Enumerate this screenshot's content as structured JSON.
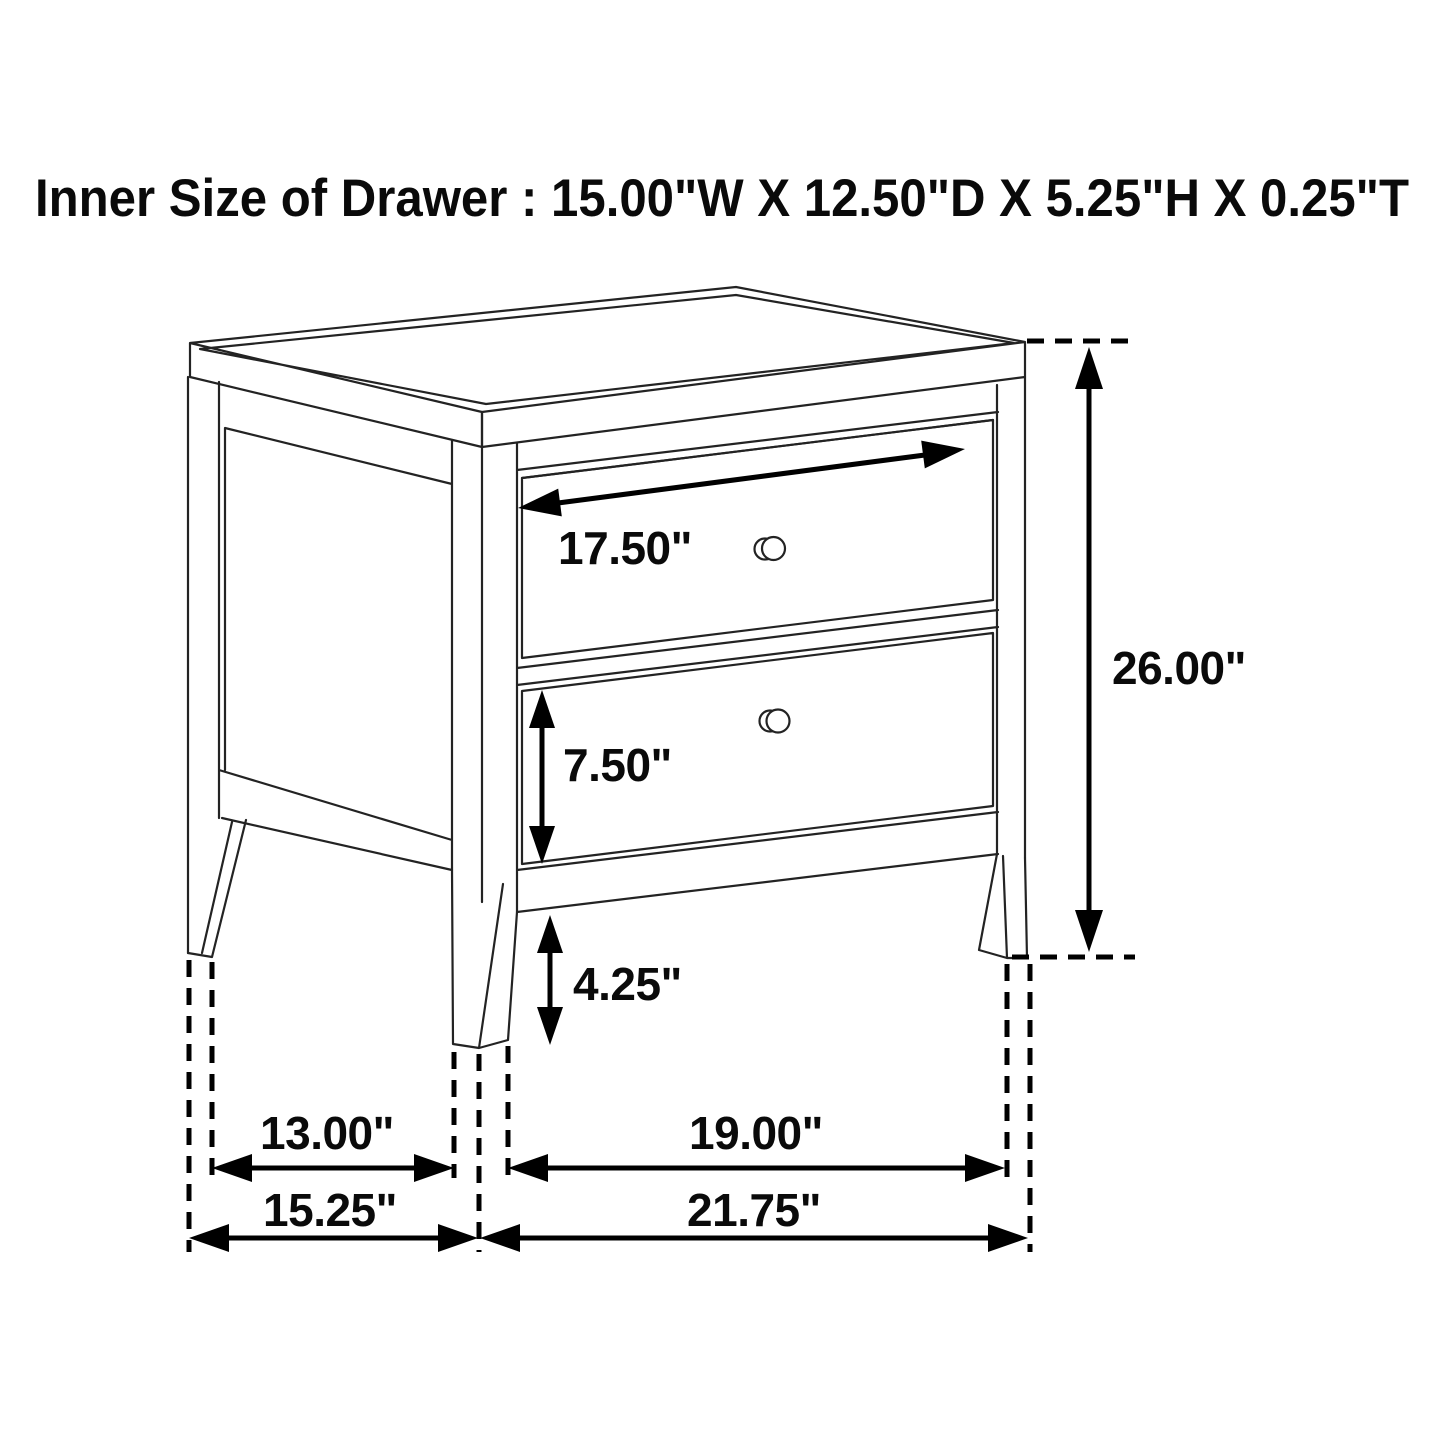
{
  "title": "Inner Size of Drawer : 15.00\"W X 12.50\"D X 5.25\"H X 0.25\"T",
  "diagram": {
    "type": "furniture-dimension-diagram",
    "item": "two-drawer nightstand line drawing",
    "colors": {
      "background": "#ffffff",
      "line": "#232323",
      "dimension": "#000000"
    },
    "labels": {
      "drawer_face_width": "17.50\"",
      "overall_height": "26.00\"",
      "lower_drawer_height": "7.50\"",
      "leg_clearance": "4.25\"",
      "side_leg_spacing": "13.00\"",
      "front_leg_spacing": "19.00\"",
      "overall_depth": "15.25\"",
      "overall_width": "21.75\""
    }
  }
}
